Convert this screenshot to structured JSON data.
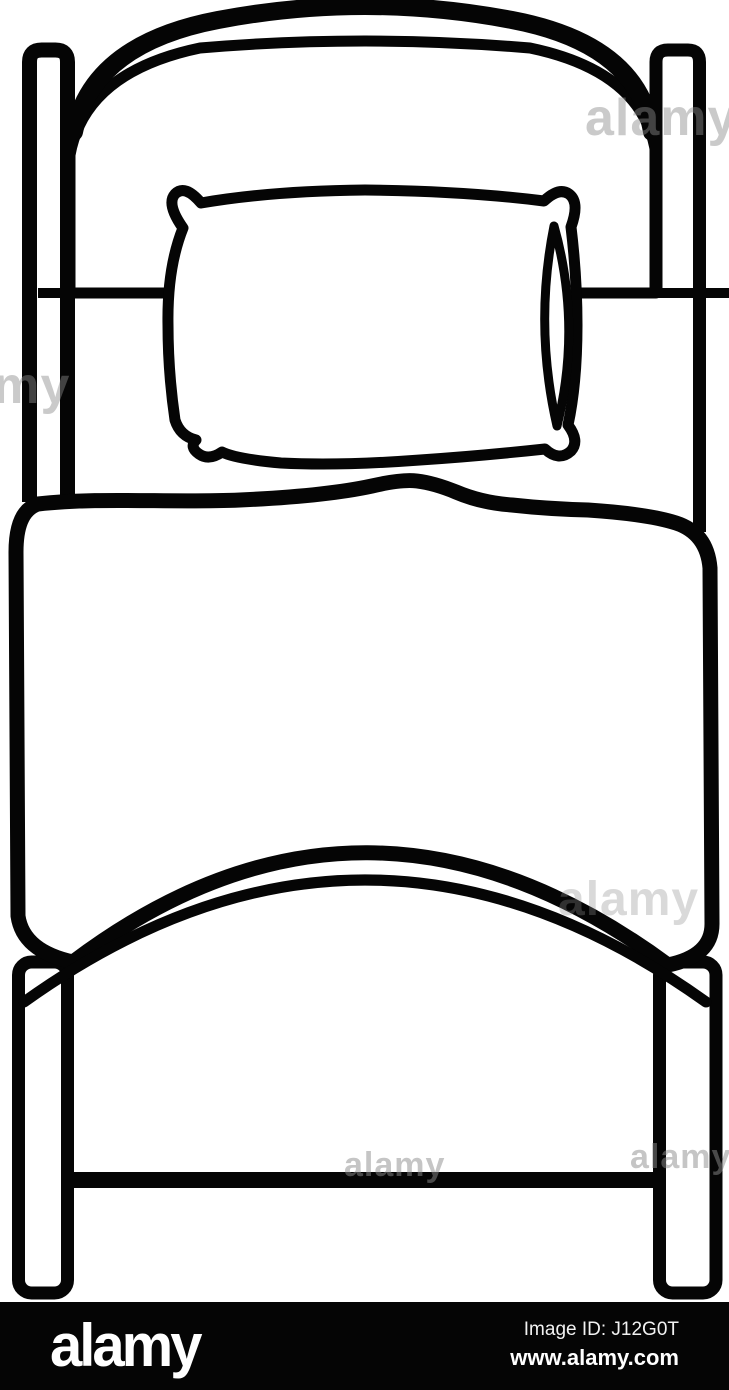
{
  "canvas": {
    "width": 729,
    "height": 1390,
    "background": "#ffffff"
  },
  "illustration": {
    "name": "single bed top view line drawing",
    "stroke_color": "#050505",
    "fill_color": "#ffffff",
    "parts": [
      "headboard-arch-outer",
      "headboard-panel",
      "headboard-left-post",
      "headboard-right-post",
      "headboard-rail",
      "right-side-rail",
      "pillow",
      "pillow-side-fold",
      "blanket",
      "footboard-arch",
      "footboard-rail",
      "left-leg",
      "right-leg"
    ]
  },
  "watermark": {
    "text": "alamy",
    "color": "#8c8c8c"
  },
  "footer": {
    "background": "#050505",
    "brand": "alamy",
    "image_id": "Image ID: J12G0T",
    "website": "www.alamy.com",
    "text_color": "#ffffff"
  }
}
